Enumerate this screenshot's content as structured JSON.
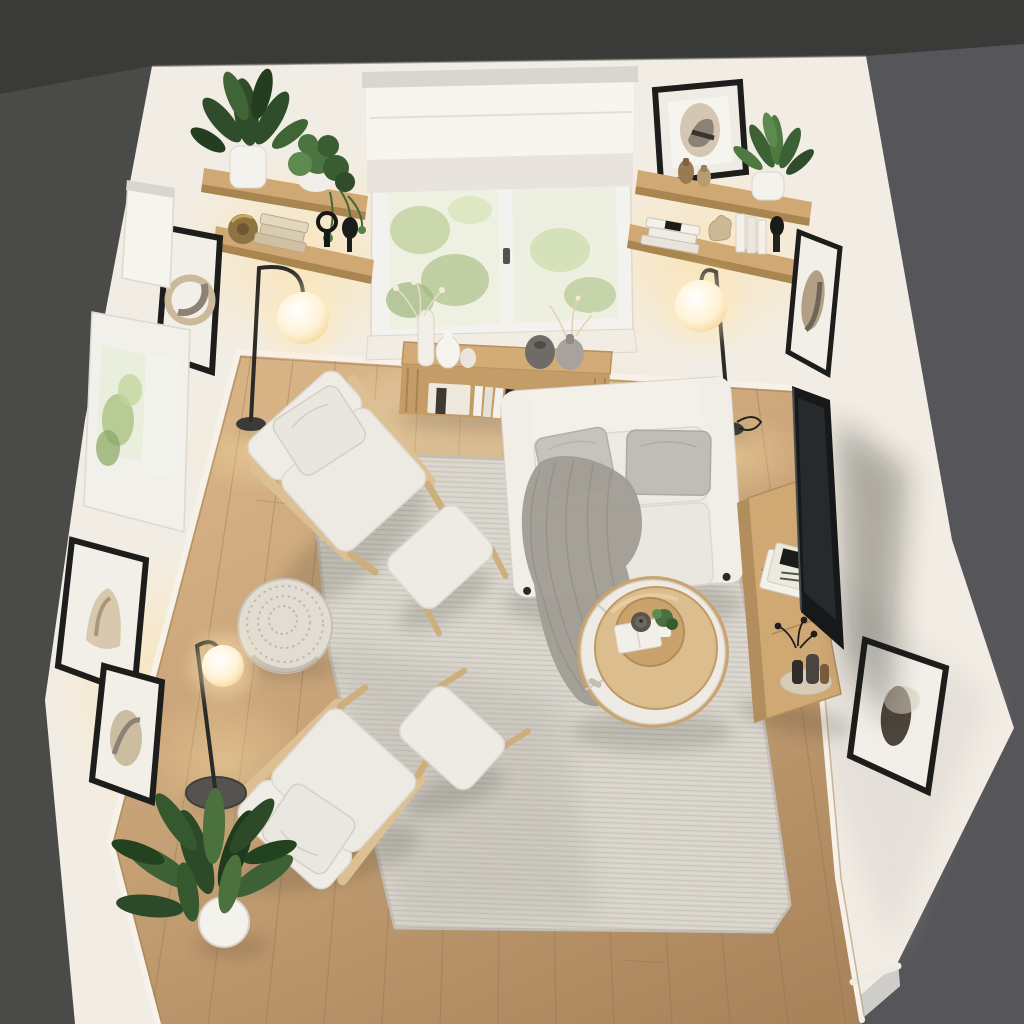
{
  "scene": {
    "type": "interior-render",
    "view": "top-down bird's-eye",
    "room": "small Scandinavian living room",
    "description": "Overhead dollhouse view of a compact living room: white walls inside dark charcoal outer walls, light oak plank floor, large woven gray rug, white loveseat with gray pillows and knit throw, two wood-frame armchairs with ottomans, knitted pouf, round two-tone coffee table, wall TV over an oak media console, window with sheer roman shade, oak floating shelves with plants and books, three glowing globe floor lamps, framed abstract art and green plants"
  },
  "palette": {
    "outer_wall_top": "#3a3a38",
    "outer_wall_left": "#4a4a48",
    "outer_wall_right": "#56565a",
    "wall_white": "#f2ede4",
    "rug": "#d8d4cb",
    "sofa_fabric": "#efebe3",
    "cushion_gray": "#c6c3bc",
    "throw_gray": "#a29e96",
    "wood_furniture": "#cfa873",
    "chair_wood": "#dcbf93",
    "table_top_wood": "#dcbd8e",
    "drawer_white": "#eeebe5",
    "tv_black": "#17181a",
    "frame_black": "#1d1d1b",
    "plant_green": "#3a5c33",
    "lamp_glow": "#fff3d8",
    "pot_white": "#f4f2ed",
    "shade_white": "#f7f5f0",
    "pouf_knit": "#e2ddd2",
    "floor_wood": "#c6a176",
    "baseboard": "#f6f1e7"
  },
  "objects": {
    "window_top": "double casement window with sheer roman shade, greenery outside",
    "console_table": "slatted oak console under window with white and stone vases, sprigs, books",
    "shelves_left": "two floating oak shelves: rubber plant, trailing pothos, brass canister, book stack, black candle sculptures",
    "shelves_right": "two floating oak shelves: leaning framed portrait print, amber vases, fern in white pot, magazines, white books, dark candlestick",
    "sofa": "white two-seat sofa with two gray pillows and draped knit throw",
    "armchair_upper": "wood-frame lounge chair with white cushions and footstool",
    "armchair_lower": "wood-frame lounge chair with white cushions and footstool",
    "pouf": "round knitted pouf",
    "coffee_table": "round coffee table, oak top with white drawer base, tray with book, candle and plant",
    "tv": "flat-screen TV against right wall",
    "media_console": "oak media console with magazines, black sprig and bottle vases",
    "floor_lamps": "three black arc floor lamps with glowing white globes",
    "plant_floor": "large green plant in white pot, lower-left corner",
    "frames_left_wall": "three black-framed abstract prints and a small shaded window",
    "frames_right_wall": "two black-framed abstract prints",
    "rug": "large light-gray flatweave rug",
    "floor": "light oak plank flooring"
  }
}
